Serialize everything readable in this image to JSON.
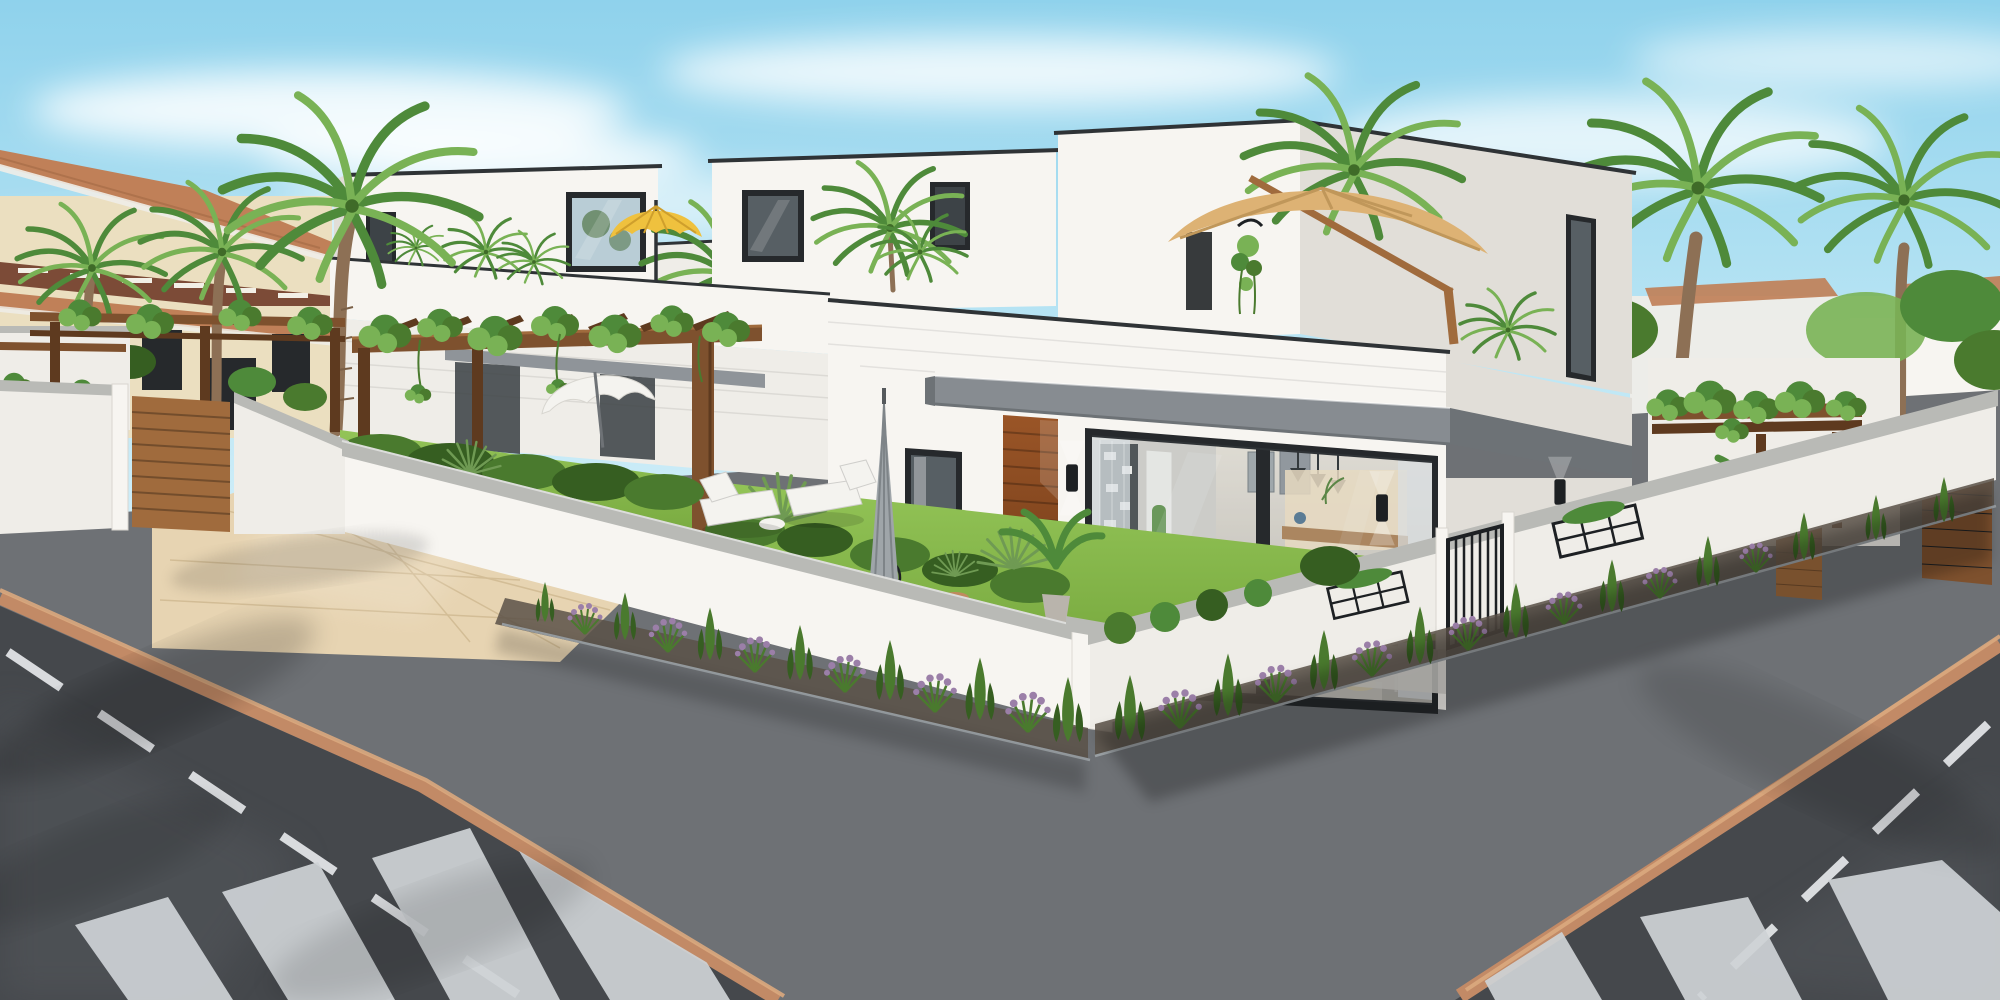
{
  "scene": {
    "type": "3d-architectural-exterior-render",
    "setting": "Modern white flat-roof villas on a sunny street corner with palm trees",
    "time_of_day": "day",
    "sky": "clear blue sky with wispy white clouds",
    "left_background": "cream Mediterranean apartment building with terracotta tiled roofs and brown balcony band",
    "main_subject": "two-storey white cubic villas with roof terraces, wooden pergolas, corten entrance door and glass sliding doors showing a furnished living room",
    "street": "two asphalt roads meeting at the corner, tan curbs, zebra crosswalks, white dashed lane lines, beige paver driveway",
    "vegetation": [
      "palm trees",
      "climbing vines on pergolas",
      "clipped hedges",
      "yucca plants",
      "lavender border strips",
      "green lawn"
    ],
    "furniture": [
      "yellow terrace parasol",
      "beige cantilever parasol",
      "white garden umbrella",
      "closed grey umbrella",
      "black bistro set",
      "two sun loungers",
      "grey sectional sofa seen through glass"
    ]
  },
  "palette": {
    "sky_top": "#8fd2ec",
    "sky_mid": "#c3e9f6",
    "sky_low": "#ecf8fd",
    "cloud": "#ffffff",
    "wall_sun": "#f7f5f1",
    "wall_lit": "#efede8",
    "wall_shade": "#e1ded8",
    "wall_dark": "#d1cec8",
    "roof_cap": "#2f3336",
    "window_frame": "#26292c",
    "glass_dark": "#3d4347",
    "glass_mid": "#575f64",
    "glass_sky": "#b9cdd6",
    "concrete": "#878c91",
    "concrete_dark": "#6d7276",
    "corten": "#9a5527",
    "corten_dark": "#6f3a18",
    "wood": "#7e512e",
    "wood_dark": "#5e3a1f",
    "wood_light": "#a06b3d",
    "leaf": "#4e8a3a",
    "leaf_light": "#79b255",
    "vine_dark": "#3f6b28",
    "lawn": "#77a83e",
    "lawn_light": "#93c457",
    "hedge": "#4a7a2e",
    "hedge_dark": "#365e21",
    "yucca": "#6f9a53",
    "lavender": "#9b7fa8",
    "terracotta": "#c08058",
    "terracotta_dark": "#a26944",
    "cream": "#ebdfc0",
    "cream_shade": "#ddcfae",
    "balcony_brown": "#7c4b37",
    "yellow": "#efc13e",
    "yellow_dark": "#cf9f2c",
    "tan": "#ddb274",
    "tan_dark": "#c0975a",
    "umb_white": "#f4f3ef",
    "umb_gray": "#9fa5a9",
    "metal_black": "#1d2023",
    "road": "#45484c",
    "road_light": "#565a5e",
    "sidewalk": "#6e7175",
    "curb": "#c28a66",
    "curb_light": "#daa87e",
    "stripe": "#ced2d5",
    "lane": "#e6e8ea",
    "paver": "#e7d4b2",
    "paver_line": "#d3bd96",
    "coping": "#b9bab6",
    "soil": "#5a5148",
    "trunk": "#8d7055",
    "interior_warm": "#eedcbd",
    "interior_wall": "#d8d4cf",
    "sofa": "#aeb6bc",
    "sofa_dark": "#8c959c",
    "pink": "#e3aeae",
    "step_gray": "#cfcdc9",
    "terrace_floor": "#d8d6d1"
  }
}
